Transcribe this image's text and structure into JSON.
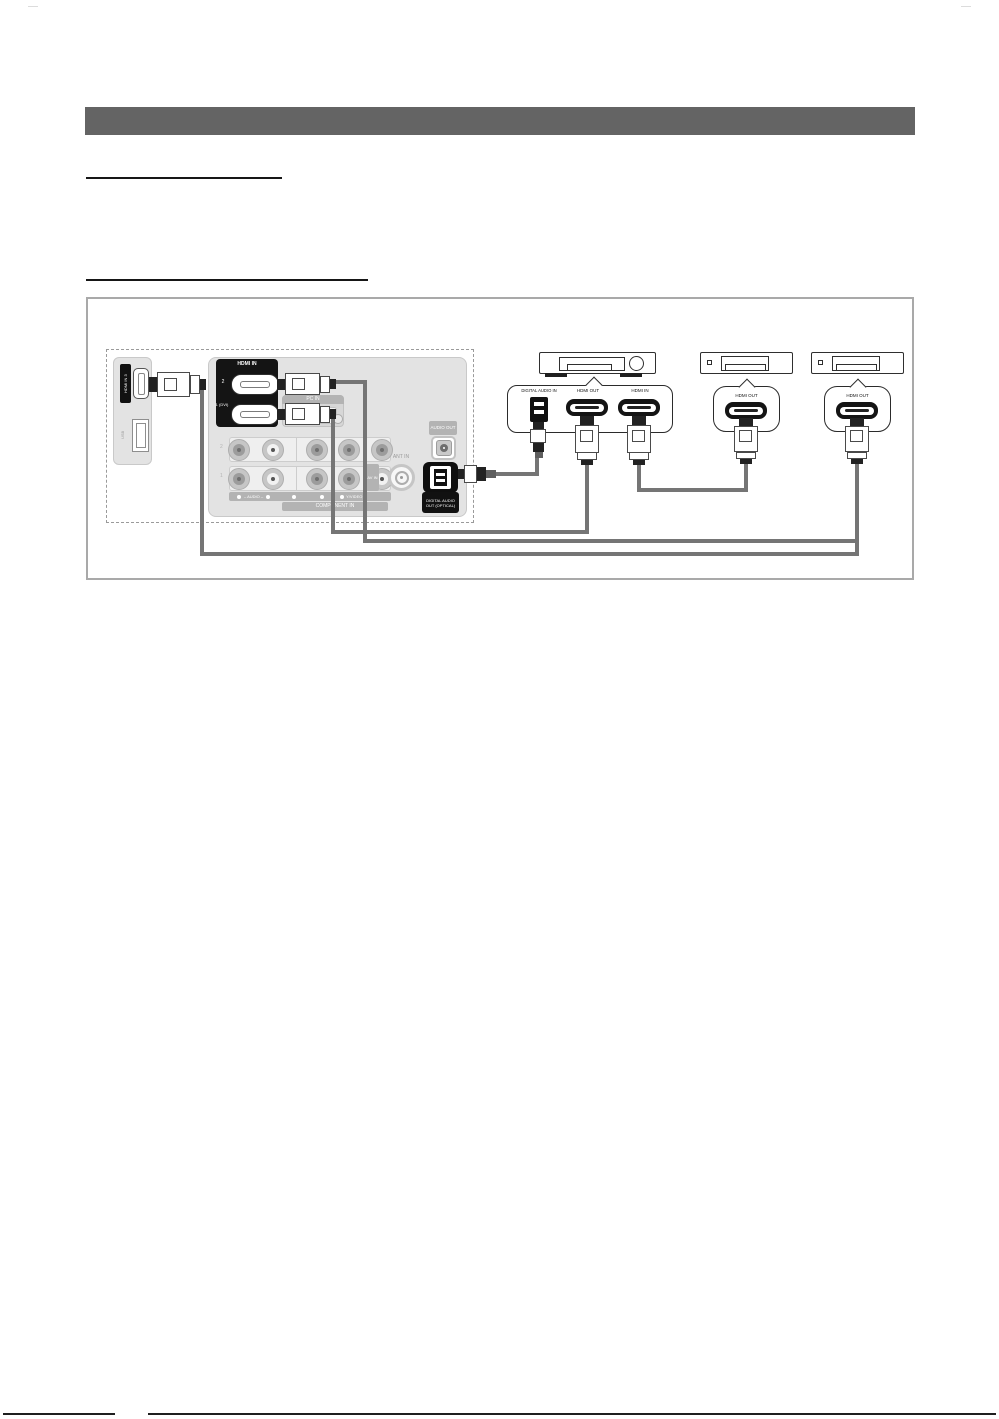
{
  "figure": {
    "tv": {
      "side": {
        "hdmi3": "HDMI IN 3",
        "usb": "USB"
      },
      "hdmi_block": {
        "title": "HDMI IN",
        "port2": "2",
        "port1": "1 (DVI)"
      },
      "pc_in": "PC IN",
      "component": {
        "row2": "2",
        "row1": "1",
        "audio": "– AUDIO –",
        "y_video": "Y/VIDEO",
        "title": "COMPONENT IN"
      },
      "av_in": "AV IN",
      "ant_in": "ANT IN",
      "audio_out": "AUDIO OUT",
      "digital_audio_out": "DIGITAL AUDIO OUT (OPTICAL)"
    },
    "home_theater": {
      "digital_audio_in": "DIGITAL AUDIO IN",
      "hdmi_out": "HDMI OUT",
      "hdmi_in": "HDMI IN"
    },
    "device2": {
      "hdmi_out": "HDMI OUT"
    },
    "device3": {
      "hdmi_out": "HDMI OUT"
    }
  },
  "colors": {
    "header_bar": "#646464",
    "cable": "#757575",
    "panel_fill": "#e3e3e3",
    "black_block": "#141414",
    "gray_label": "#b3b3b3",
    "figure_border": "#a9a9a9"
  }
}
